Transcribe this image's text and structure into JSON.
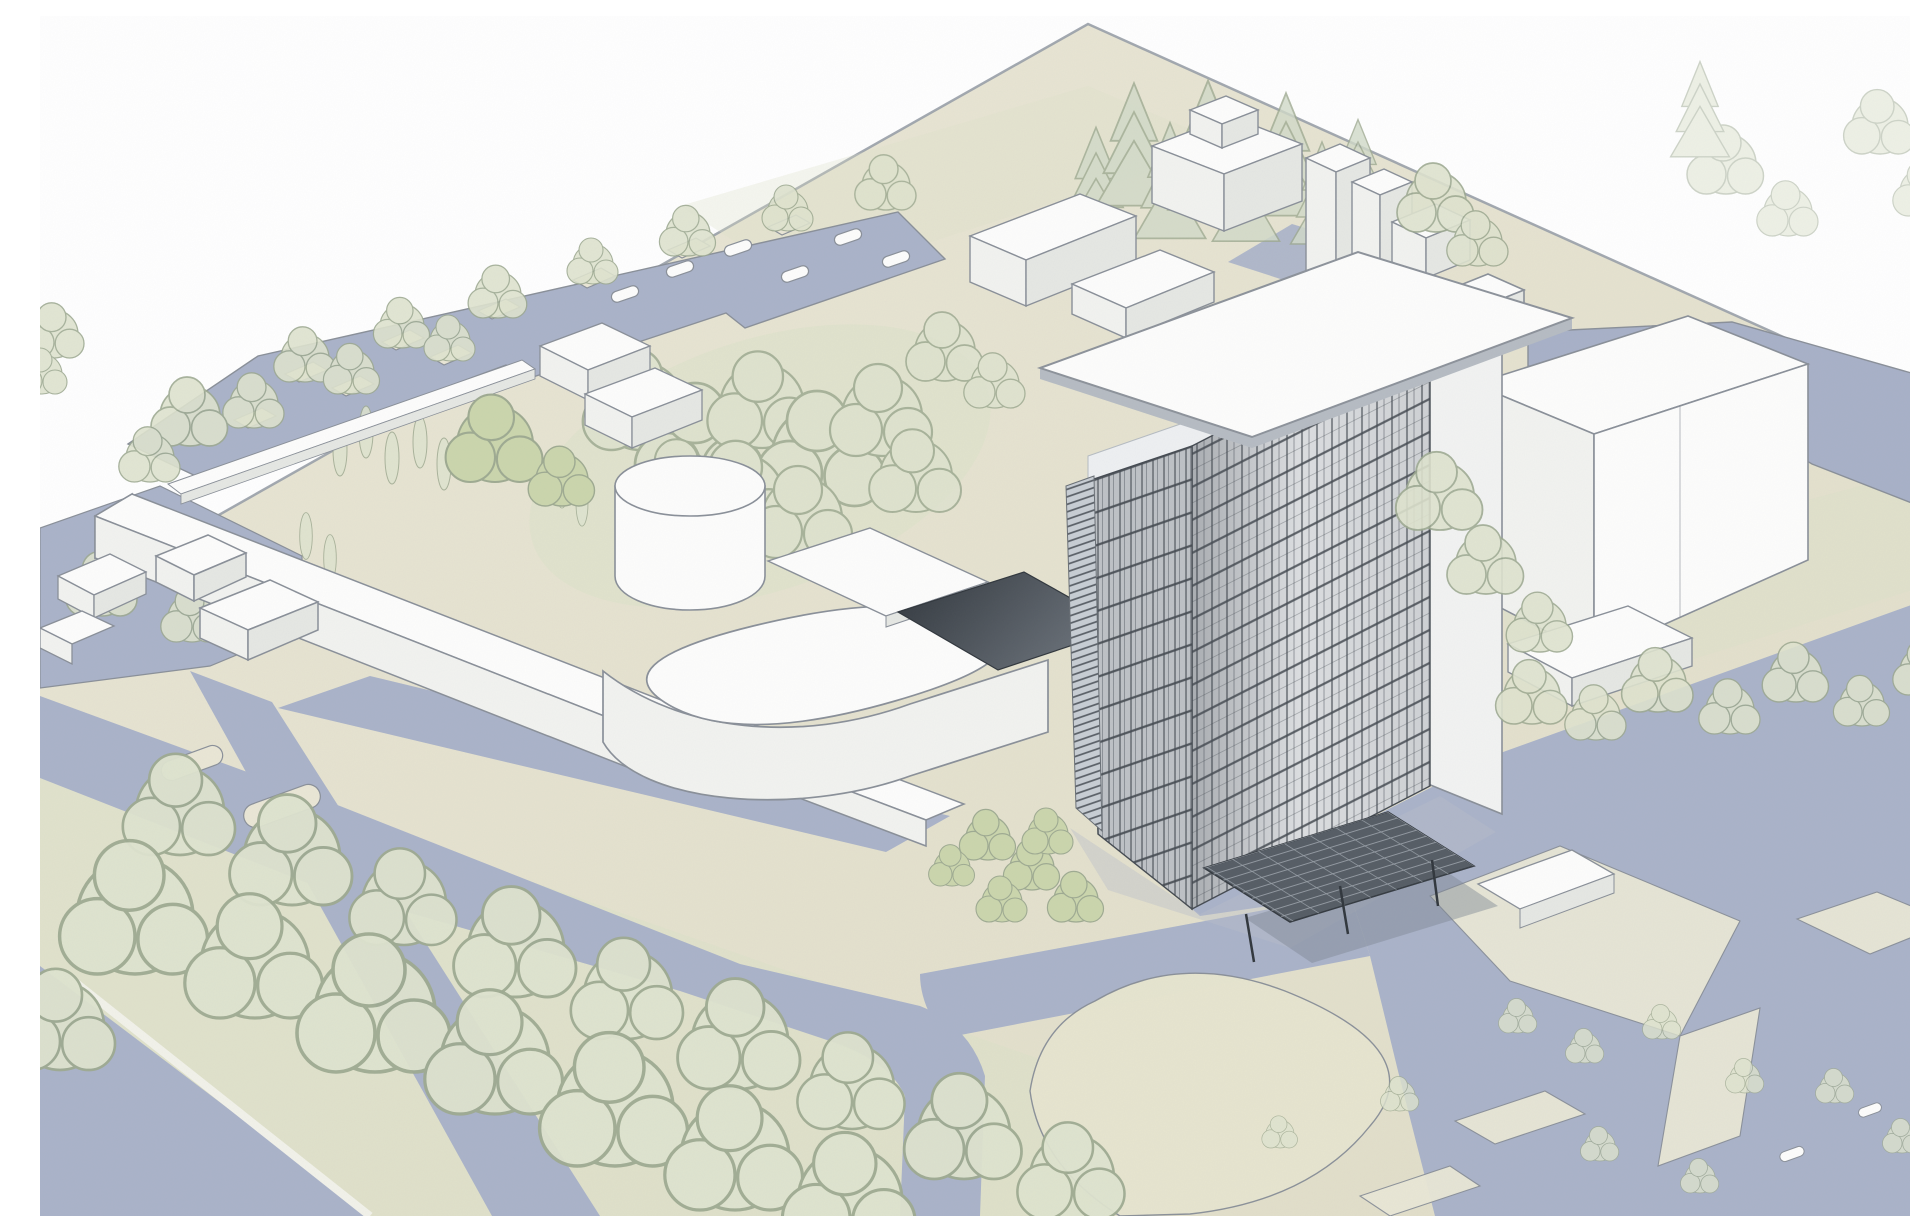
{
  "scene": {
    "type": "Architectural aerial perspective sketch",
    "description": "Hand-drawn style site rendering of a campus: a gridded curtain-wall high-rise tower with an overhanging flat roof slab, low white buildings, a cylindrical drum, a rounded-corner hall, tree-lined parking, blue-grey roads and plazas, a pond and rows of trees.",
    "elements": [
      {
        "name": "high-rise-tower",
        "label": "14-storey curtain-wall tower with roof slab and entry canopy"
      },
      {
        "name": "parking-lot",
        "label": "tree-lined parking lot with cars, upper left"
      },
      {
        "name": "long-slab-building",
        "label": "long low linear building"
      },
      {
        "name": "cylinder-building",
        "label": "cylindrical drum volume"
      },
      {
        "name": "rounded-hall",
        "label": "large rounded-corner hall"
      },
      {
        "name": "link-bridge",
        "label": "white and dark flat link roofs to the tower"
      },
      {
        "name": "service-boxes",
        "label": "white utility volumes with stacks behind the tower"
      },
      {
        "name": "large-box-building",
        "label": "large white box building, right"
      },
      {
        "name": "pond",
        "label": "water body, upper right"
      },
      {
        "name": "road-network",
        "label": "blue-grey roads, plazas and parking paving"
      },
      {
        "name": "lawn-square",
        "label": "rounded-square lawn ringed by a road"
      },
      {
        "name": "tree-rows",
        "label": "double row of round trees along the boulevard"
      },
      {
        "name": "conifer-grove",
        "label": "conifer group behind the service boxes"
      },
      {
        "name": "court-bench",
        "label": "small white court wall near the tower plaza"
      }
    ]
  },
  "palette": {
    "sky": "#ffffff",
    "ground": "#eae7d6",
    "ground2": "#e2dfca",
    "green": "#dde2c9",
    "lawn": "#e8e6d0",
    "paving": "#aab3c9",
    "water": "#a8b1c8",
    "path": "#eae8d6",
    "white": "#fdfdfc",
    "face": "#f2f3f0",
    "face2": "#e6e8e4",
    "line": "#8a9099",
    "dark": "#454b52",
    "facadeA": "#e9ebed",
    "facadeB": "#d8dce0",
    "louver": "#c8ced4",
    "canopy": "#565d65",
    "canopyline": "#99a0a8",
    "dark1": "#31373d",
    "dark2": "#6a7179",
    "tree": "#dfe4cf",
    "treeline": "#9fab92",
    "bright": "#cbd6ad",
    "conifer": "#d2dbc9",
    "shadow": "#b9bfca",
    "roofband": "#b6bcc3",
    "wall": "#f2f3f2",
    "parapet": "#eef0f2",
    "curb": "#f2f2ea",
    "boundary": "#99a0a8"
  }
}
